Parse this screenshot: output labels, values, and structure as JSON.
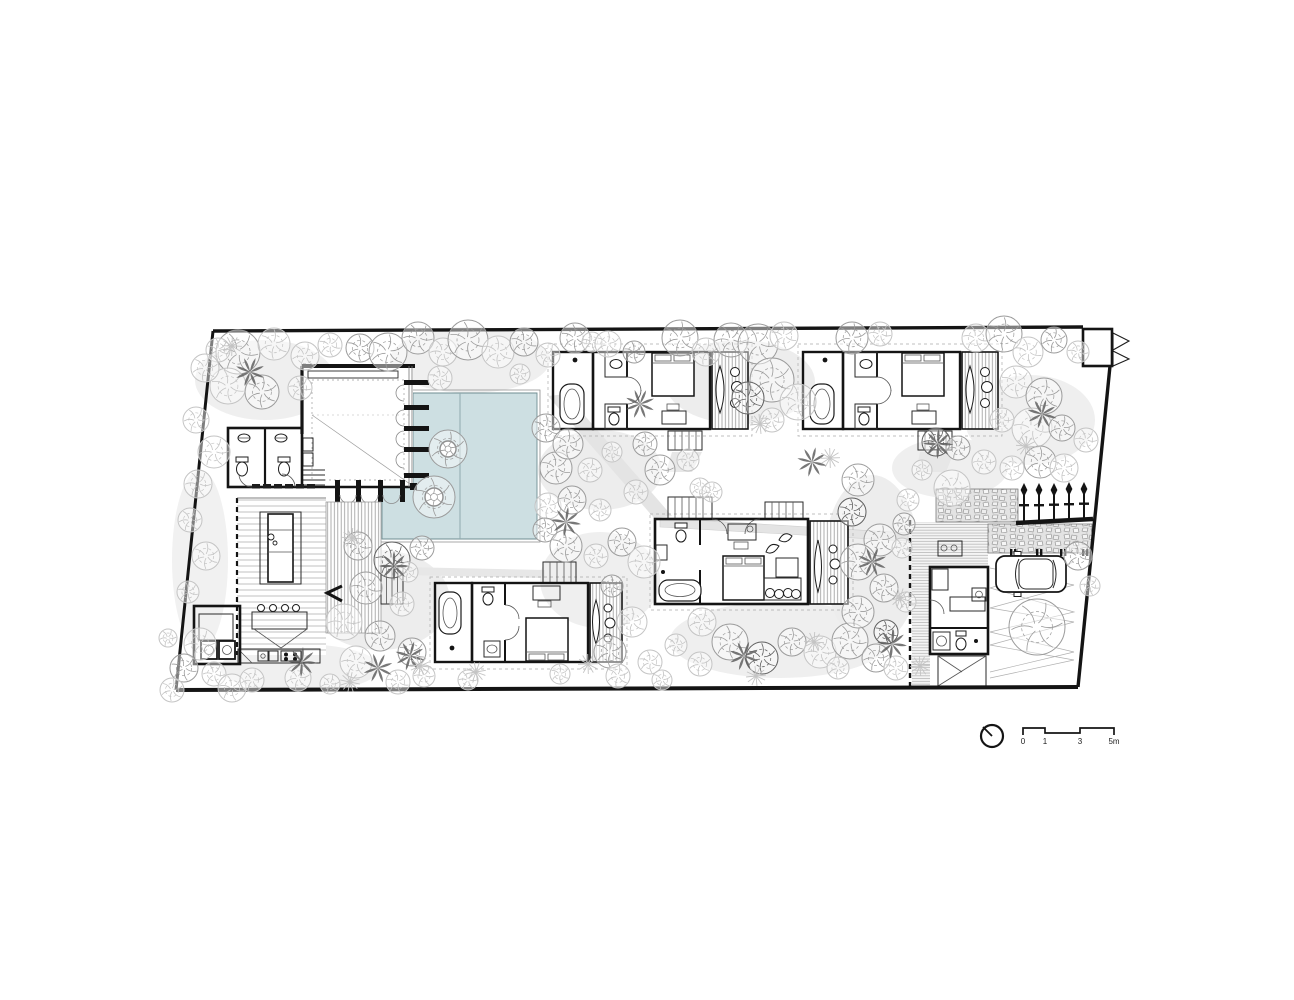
{
  "drawing": {
    "kind_label": "",
    "scale_bar": {
      "labels": [
        "0",
        "1",
        "3",
        "5m"
      ]
    }
  },
  "colors": {
    "pool": "#cddfe2",
    "pool_edge": "#6f8d92",
    "wall": "#141414",
    "deck_line": "#9a9a9a",
    "ground": "#e9e9e9",
    "tree_light": "#c4c4c4",
    "tree_mid": "#9b9b9b",
    "tree_dark": "#5f5f5f",
    "background": "#ffffff"
  }
}
